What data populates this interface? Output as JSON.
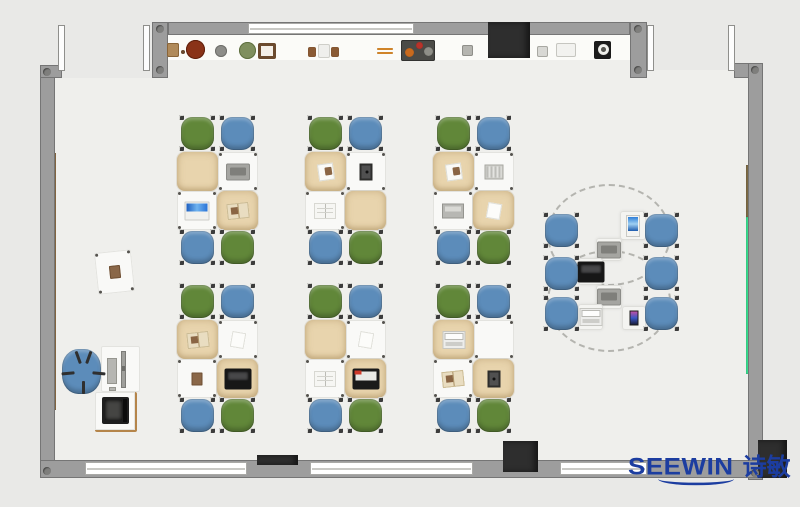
{
  "meta": {
    "description": "Top-down classroom furniture floor plan rendering"
  },
  "palette": {
    "background": "#e9e9e7",
    "floor": "#efefec",
    "shelf": "#fbfbf8",
    "wall": "#9d9d9d",
    "window": "#ffffff",
    "green_chair": "#618739",
    "blue_chair": "#5c8cba",
    "beige_desk": "#e8d4ad",
    "white_desk": "#f9f9f7",
    "dark_block": "#2e2e2e",
    "wood_strip": "#8a6b45",
    "green_strip": "#38d98c",
    "logo_blue": "#1c3da0"
  },
  "logo": {
    "brand": "SEEWIN",
    "cn": "诗敏"
  },
  "scene": {
    "floor": [
      {
        "x": 55,
        "y": 78,
        "w": 693,
        "h": 382
      },
      {
        "x": 167,
        "y": 60,
        "w": 480,
        "h": 18
      },
      {
        "x": 647,
        "y": 70,
        "w": 101,
        "h": 8
      }
    ],
    "shelf_band": {
      "x": 167,
      "y": 35,
      "w": 463,
      "h": 25
    },
    "walls": [
      {
        "x": 40,
        "y": 65,
        "w": 15,
        "h": 413
      },
      {
        "x": 40,
        "y": 65,
        "w": 22,
        "h": 13
      },
      {
        "x": 152,
        "y": 22,
        "w": 16,
        "h": 56
      },
      {
        "x": 168,
        "y": 22,
        "w": 462,
        "h": 13
      },
      {
        "x": 630,
        "y": 22,
        "w": 17,
        "h": 56
      },
      {
        "x": 734,
        "y": 63,
        "w": 29,
        "h": 15
      },
      {
        "x": 748,
        "y": 63,
        "w": 15,
        "h": 417
      },
      {
        "x": 40,
        "y": 460,
        "w": 723,
        "h": 18
      }
    ],
    "windows": [
      {
        "x": 248,
        "y": 23,
        "w": 166,
        "h": 11
      },
      {
        "x": 85,
        "y": 462,
        "w": 162,
        "h": 13
      },
      {
        "x": 310,
        "y": 462,
        "w": 163,
        "h": 13
      },
      {
        "x": 560,
        "y": 462,
        "w": 87,
        "h": 13
      }
    ],
    "jambs": [
      {
        "x": 58,
        "y": 25,
        "w": 7,
        "h": 46
      },
      {
        "x": 143,
        "y": 25,
        "w": 7,
        "h": 46
      },
      {
        "x": 647,
        "y": 25,
        "w": 7,
        "h": 46
      },
      {
        "x": 728,
        "y": 25,
        "w": 7,
        "h": 46
      }
    ],
    "dark_blocks": [
      {
        "x": 488,
        "y": 22,
        "w": 42,
        "h": 36
      },
      {
        "x": 257,
        "y": 455,
        "w": 41,
        "h": 10
      },
      {
        "x": 503,
        "y": 441,
        "w": 35,
        "h": 31
      },
      {
        "x": 758,
        "y": 440,
        "w": 29,
        "h": 38
      }
    ],
    "corner_dots": [
      {
        "x": 43,
        "y": 68
      },
      {
        "x": 43,
        "y": 467
      },
      {
        "x": 751,
        "y": 66
      },
      {
        "x": 751,
        "y": 469
      },
      {
        "x": 156,
        "y": 25
      },
      {
        "x": 156,
        "y": 66
      },
      {
        "x": 634,
        "y": 25
      },
      {
        "x": 634,
        "y": 66
      }
    ],
    "strips": [
      {
        "name": "wood-rail-left",
        "x": 52,
        "y": 153,
        "w": 4,
        "h": 257,
        "c": "#8a6b45"
      },
      {
        "name": "wood-rail-right",
        "x": 746,
        "y": 165,
        "w": 4,
        "h": 52,
        "c": "#7c6a45"
      },
      {
        "name": "green-board-right",
        "x": 746,
        "y": 217,
        "w": 4,
        "h": 157,
        "c": "#38d98c"
      }
    ]
  },
  "shelf_items": [
    {
      "n": "basket",
      "x": 167,
      "y": 43,
      "w": 12,
      "h": 14,
      "c": "#b08a5a",
      "b": "#8a6538"
    },
    {
      "n": "small-dot",
      "x": 181,
      "y": 50,
      "w": 4,
      "h": 4,
      "c": "#6b4a2e",
      "round": true
    },
    {
      "n": "red-pot",
      "x": 186,
      "y": 40,
      "w": 19,
      "h": 19,
      "c": "#8a3318",
      "b": "#5e1f0c",
      "round": true
    },
    {
      "n": "gray-pot",
      "x": 215,
      "y": 45,
      "w": 12,
      "h": 12,
      "c": "#8d8d89",
      "b": "#6f6f6b",
      "round": true
    },
    {
      "n": "plant",
      "x": 239,
      "y": 42,
      "w": 17,
      "h": 17,
      "c": "#7f8f5e",
      "b": "#5f7040",
      "round": true
    },
    {
      "n": "picture-frame",
      "x": 258,
      "y": 43,
      "w": 18,
      "h": 16,
      "c": "#f4efe8",
      "b": "#6b4a2e",
      "bw": 3
    },
    {
      "n": "bookend",
      "x": 308,
      "y": 47,
      "w": 8,
      "h": 10,
      "c": "#8a5a34"
    },
    {
      "n": "book",
      "x": 318,
      "y": 44,
      "w": 12,
      "h": 14,
      "c": "#efefec",
      "b": "#cfcfc9"
    },
    {
      "n": "bookend",
      "x": 331,
      "y": 47,
      "w": 8,
      "h": 10,
      "c": "#8a5a34"
    },
    {
      "n": "stick",
      "x": 377,
      "y": 48,
      "w": 16,
      "h": 2,
      "c": "#d98a2b"
    },
    {
      "n": "stick",
      "x": 377,
      "y": 52,
      "w": 16,
      "h": 2,
      "c": "#d98a2b"
    },
    {
      "n": "art-tray",
      "x": 401,
      "y": 40,
      "w": 34,
      "h": 21,
      "c": "#4b4b47",
      "b": "#323230"
    },
    {
      "n": "tray-orange",
      "x": 405,
      "y": 48,
      "w": 9,
      "h": 9,
      "c": "#c96a1e",
      "round": true
    },
    {
      "n": "tray-red",
      "x": 416,
      "y": 42,
      "w": 7,
      "h": 7,
      "c": "#b8332a",
      "round": true
    },
    {
      "n": "tray-gray",
      "x": 424,
      "y": 47,
      "w": 9,
      "h": 9,
      "c": "#8f8f88",
      "round": true
    },
    {
      "n": "small-box",
      "x": 462,
      "y": 45,
      "w": 11,
      "h": 11,
      "c": "#b5b5b0",
      "b": "#8f8f8a"
    },
    {
      "n": "card",
      "x": 537,
      "y": 46,
      "w": 11,
      "h": 11,
      "c": "#d8d8d4",
      "b": "#a8a8a2"
    },
    {
      "n": "shelf-unit",
      "x": 556,
      "y": 43,
      "w": 20,
      "h": 14,
      "c": "#f2f2ef",
      "b": "#c6c6c0"
    },
    {
      "n": "clock-body",
      "x": 594,
      "y": 41,
      "w": 17,
      "h": 18,
      "c": "#1c1c1c"
    },
    {
      "n": "clock-face",
      "x": 598,
      "y": 44,
      "w": 11,
      "h": 11,
      "c": "#f0f0ec",
      "round": true
    },
    {
      "n": "clock-center",
      "x": 601,
      "y": 47,
      "w": 5,
      "h": 5,
      "c": "#555550",
      "round": true
    }
  ],
  "clusters": {
    "positions": [
      {
        "x": 177,
        "y": 115
      },
      {
        "x": 305,
        "y": 115
      },
      {
        "x": 433,
        "y": 115
      },
      {
        "x": 177,
        "y": 283
      },
      {
        "x": 305,
        "y": 283
      },
      {
        "x": 433,
        "y": 283
      }
    ],
    "chair_rel": [
      {
        "x": 4,
        "y": 2
      },
      {
        "x": 44,
        "y": 2
      },
      {
        "x": 4,
        "y": 116
      },
      {
        "x": 44,
        "y": 116
      }
    ],
    "chair_size": 33,
    "chair_colors": [
      "g",
      "b",
      "b",
      "g"
    ],
    "desk_rel": [
      {
        "x": 0,
        "y": 37,
        "w": 41,
        "h": 39
      },
      {
        "x": 41,
        "y": 37,
        "w": 40,
        "h": 39
      },
      {
        "x": 0,
        "y": 76,
        "w": 40,
        "h": 39
      },
      {
        "x": 40,
        "y": 76,
        "w": 41,
        "h": 39
      }
    ],
    "desk_colors": [
      "beige",
      "white",
      "white",
      "beige"
    ],
    "items": [
      [
        null,
        "gray-laptop",
        "blue-laptop",
        "open-book-tan"
      ],
      [
        "paper-brown",
        "dark-tablet",
        "open-book",
        null
      ],
      [
        "paper-brown",
        "notebook",
        "flat-laptop",
        "paper"
      ],
      [
        "open-book-tan",
        "paper",
        "brown-book",
        "black-laptop"
      ],
      [
        null,
        "paper",
        "open-book",
        "black-laptop-red"
      ],
      [
        "white-laptop",
        null,
        "open-book-tan",
        "dark-tablet"
      ]
    ]
  },
  "pod": {
    "arcs": [
      {
        "x": 547,
        "y": 184,
        "w": 120,
        "h": 98
      },
      {
        "x": 547,
        "y": 250,
        "w": 120,
        "h": 98
      }
    ],
    "chair_size": 33,
    "chairs": [
      {
        "x": 545,
        "y": 214
      },
      {
        "x": 545,
        "y": 257
      },
      {
        "x": 545,
        "y": 297
      },
      {
        "x": 645,
        "y": 214
      },
      {
        "x": 645,
        "y": 257
      },
      {
        "x": 645,
        "y": 297
      }
    ],
    "tables": [
      {
        "x": 620,
        "y": 211,
        "w": 26,
        "h": 29,
        "item": "tablet-blue"
      },
      {
        "x": 596,
        "y": 238,
        "w": 26,
        "h": 23,
        "item": "gray-laptop"
      },
      {
        "x": 578,
        "y": 258,
        "w": 25,
        "h": 27,
        "item": "black-laptop"
      },
      {
        "x": 596,
        "y": 285,
        "w": 26,
        "h": 24,
        "item": "gray-laptop"
      },
      {
        "x": 578,
        "y": 304,
        "w": 25,
        "h": 26,
        "item": "white-laptop"
      },
      {
        "x": 622,
        "y": 306,
        "w": 24,
        "h": 24,
        "item": "phone"
      }
    ]
  },
  "teacher": {
    "side_desk": {
      "x": 96,
      "y": 251,
      "w": 37,
      "h": 42,
      "rot": -6,
      "item": "brown-book"
    },
    "chair": {
      "x": 62,
      "y": 349,
      "w": 39,
      "h": 45
    },
    "chair_leg_angles": [
      20,
      95,
      180,
      265,
      340
    ],
    "desk": {
      "x": 101,
      "y": 346,
      "w": 39,
      "h": 46
    },
    "monitor": {
      "x": 121,
      "y": 351,
      "w": 5,
      "h": 37
    },
    "keyboard": {
      "x": 107,
      "y": 358,
      "w": 10,
      "h": 26
    },
    "mouse": {
      "x": 109,
      "y": 387,
      "w": 7,
      "h": 4
    },
    "printer_table": {
      "x": 95,
      "y": 392,
      "w": 42,
      "h": 40
    },
    "printer": {
      "x": 102,
      "y": 397,
      "w": 27,
      "h": 27
    }
  }
}
